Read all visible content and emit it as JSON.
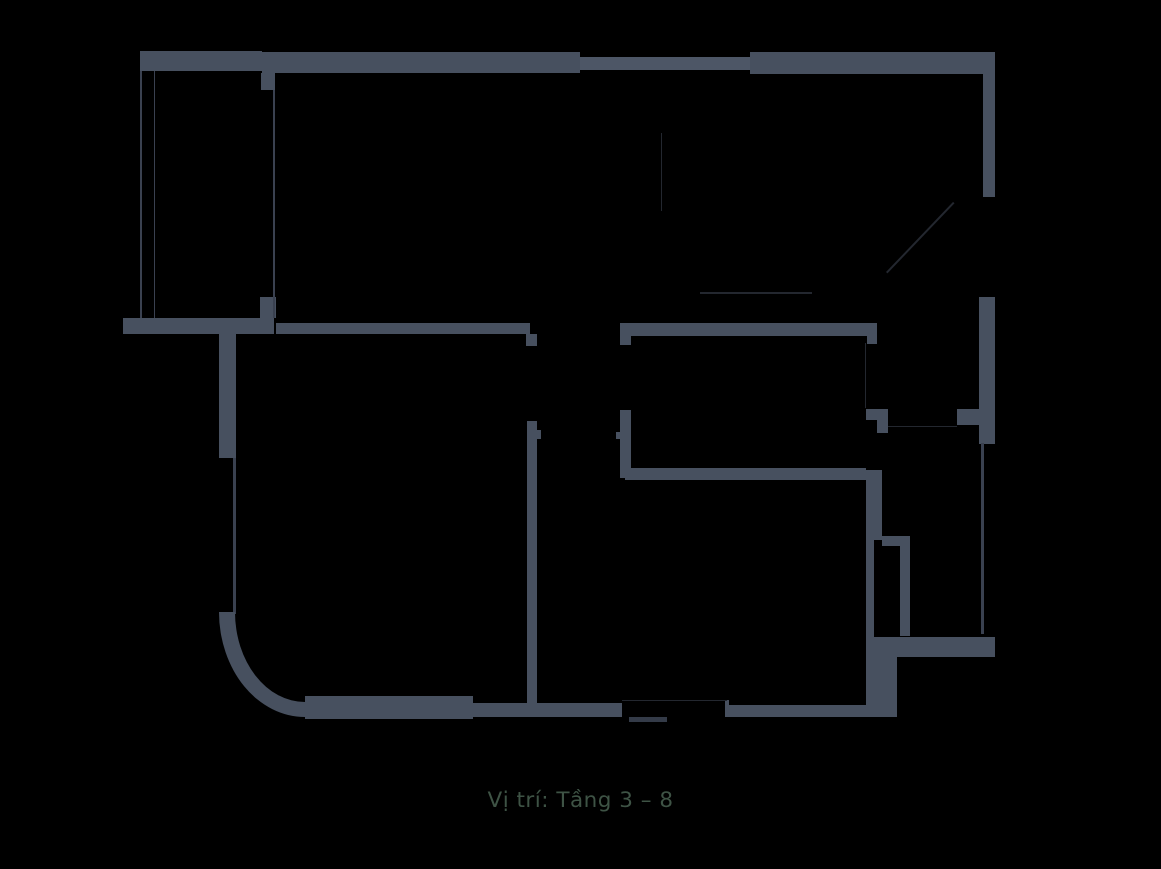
{
  "caption": {
    "text": "Vị trí: Tầng 3 – 8",
    "color": "#3e5345"
  },
  "colors": {
    "background": "#000000",
    "wall": "#47505f",
    "wall_light": "#4d5666",
    "line": "#3a4150",
    "threshold": "#343b48",
    "faint": "#23272f"
  },
  "plan": {
    "walls": [
      {
        "name": "top-wall-left",
        "x": 139.5,
        "y": 51,
        "w": 122.5,
        "h": 19.5,
        "c": "wall"
      },
      {
        "name": "top-wall-mid",
        "x": 262,
        "y": 52,
        "w": 318,
        "h": 21,
        "c": "wall"
      },
      {
        "name": "top-window-wall",
        "x": 580,
        "y": 56.5,
        "w": 170,
        "h": 13,
        "c": "wall_light"
      },
      {
        "name": "top-wall-right",
        "x": 750,
        "y": 51.5,
        "w": 245,
        "h": 22,
        "c": "wall"
      },
      {
        "name": "right-wall-upper",
        "x": 982.5,
        "y": 73.5,
        "w": 12.5,
        "h": 123,
        "c": "wall"
      },
      {
        "name": "right-wall-mid",
        "x": 979,
        "y": 296.5,
        "w": 16,
        "h": 147,
        "c": "wall"
      },
      {
        "name": "right-window-tab",
        "x": 956.5,
        "y": 408.5,
        "w": 22.5,
        "h": 16.5,
        "c": "wall"
      },
      {
        "name": "window-pier-h",
        "x": 866,
        "y": 409,
        "w": 22,
        "h": 11,
        "c": "wall"
      },
      {
        "name": "window-pier-v",
        "x": 877,
        "y": 420,
        "w": 11,
        "h": 13,
        "c": "wall"
      },
      {
        "name": "bottom-right-wall",
        "x": 874,
        "y": 636.5,
        "w": 121,
        "h": 20,
        "c": "wall"
      },
      {
        "name": "bottom-right-column",
        "x": 874,
        "y": 656.5,
        "w": 22.5,
        "h": 60.5,
        "c": "wall"
      },
      {
        "name": "bottom-wall-right",
        "x": 728.5,
        "y": 705,
        "w": 145.5,
        "h": 12,
        "c": "wall"
      },
      {
        "name": "bottom-wall-step",
        "x": 725,
        "y": 700,
        "w": 3.5,
        "h": 17,
        "c": "wall"
      },
      {
        "name": "bottom-wall-mid",
        "x": 473,
        "y": 702.5,
        "w": 149,
        "h": 14.5,
        "c": "wall"
      },
      {
        "name": "bottom-wall-left",
        "x": 305,
        "y": 696,
        "w": 168,
        "h": 22.5,
        "c": "wall"
      },
      {
        "name": "room2-top-wall",
        "x": 630,
        "y": 323,
        "w": 247,
        "h": 13,
        "c": "wall"
      },
      {
        "name": "room2-top-stub",
        "x": 620,
        "y": 322.5,
        "w": 10.5,
        "h": 22.5,
        "c": "wall"
      },
      {
        "name": "room2-top-lip",
        "x": 867,
        "y": 336,
        "w": 10,
        "h": 7.5,
        "c": "wall"
      },
      {
        "name": "room2-left-wall",
        "x": 620,
        "y": 410,
        "w": 10.5,
        "h": 67.5,
        "c": "wall"
      },
      {
        "name": "room2-door-tab",
        "x": 615.5,
        "y": 431.5,
        "w": 4.5,
        "h": 7,
        "c": "wall"
      },
      {
        "name": "room2-bottom-wall",
        "x": 625,
        "y": 467.5,
        "w": 241,
        "h": 12,
        "c": "wall"
      },
      {
        "name": "room1-top-wall",
        "x": 276,
        "y": 322.5,
        "w": 254,
        "h": 11,
        "c": "wall"
      },
      {
        "name": "room1-top-stub",
        "x": 526,
        "y": 334,
        "w": 11,
        "h": 11.5,
        "c": "wall"
      },
      {
        "name": "stair-bottom-wall",
        "x": 122.5,
        "y": 317.5,
        "w": 151,
        "h": 16.5,
        "c": "wall"
      },
      {
        "name": "stair-bottom-stub",
        "x": 260,
        "y": 296.5,
        "w": 16,
        "h": 21,
        "c": "wall"
      },
      {
        "name": "corridor-wall",
        "x": 526.5,
        "y": 420.5,
        "w": 10.5,
        "h": 284.5,
        "c": "wall"
      },
      {
        "name": "corridor-door-tab",
        "x": 537,
        "y": 430,
        "w": 4,
        "h": 8.5,
        "c": "wall"
      },
      {
        "name": "left-stem-wall",
        "x": 218.5,
        "y": 334,
        "w": 17.5,
        "h": 124,
        "c": "wall"
      },
      {
        "name": "wc-wall-upper",
        "x": 866,
        "y": 470,
        "w": 15.5,
        "h": 70,
        "c": "wall"
      },
      {
        "name": "wc-wall-lower",
        "x": 866,
        "y": 540,
        "w": 8,
        "h": 177,
        "c": "wall"
      },
      {
        "name": "wc-jog-wall",
        "x": 881.5,
        "y": 536,
        "w": 28.5,
        "h": 10,
        "c": "wall"
      },
      {
        "name": "wc-right-wall",
        "x": 900,
        "y": 546,
        "w": 10,
        "h": 90,
        "c": "wall"
      },
      {
        "name": "column",
        "x": 261,
        "y": 73,
        "w": 13.5,
        "h": 16.5,
        "c": "wall"
      },
      {
        "name": "balcony-glass-line",
        "x": 233,
        "y": 458,
        "w": 2.5,
        "h": 156,
        "c": "line"
      },
      {
        "name": "right-window-glass-line",
        "x": 981,
        "y": 443,
        "w": 2.5,
        "h": 191,
        "c": "line"
      },
      {
        "name": "stair-outline-line-1",
        "x": 139.5,
        "y": 70.5,
        "w": 2,
        "h": 247,
        "c": "line"
      },
      {
        "name": "stair-outline-line-2",
        "x": 153.5,
        "y": 70.5,
        "w": 1.5,
        "h": 247,
        "c": "line"
      },
      {
        "name": "stair-outline-line-3",
        "x": 272.5,
        "y": 89.5,
        "w": 2,
        "h": 228,
        "c": "line"
      },
      {
        "name": "door-threshold-line",
        "x": 622,
        "y": 699.5,
        "w": 105,
        "h": 1.5,
        "c": "faint"
      },
      {
        "name": "door-threshold-ticks",
        "x": 629,
        "y": 716.5,
        "w": 38,
        "h": 5,
        "c": "threshold"
      },
      {
        "name": "interior-line-v1",
        "x": 660.5,
        "y": 133,
        "w": 1.5,
        "h": 78,
        "c": "faint"
      },
      {
        "name": "interior-line-h1",
        "x": 700,
        "y": 292,
        "w": 112,
        "h": 1.5,
        "c": "faint"
      },
      {
        "name": "interior-line-v2",
        "x": 864.5,
        "y": 343,
        "w": 1.5,
        "h": 65,
        "c": "faint"
      },
      {
        "name": "window-sill-line",
        "x": 888,
        "y": 425.5,
        "w": 69,
        "h": 1.5,
        "c": "faint"
      }
    ],
    "arc": {
      "name": "balcony-curved-wall",
      "x": 218.5,
      "y": 612,
      "w": 86.5,
      "h": 105,
      "thickness_left": 16,
      "thickness_bottom": 15,
      "rx": 90,
      "ry": 110
    },
    "diagonals": [
      {
        "name": "door-swing-line",
        "x1": 886,
        "y1": 272,
        "x2": 953,
        "y2": 202,
        "t": 1.5,
        "c": "faint"
      }
    ]
  }
}
